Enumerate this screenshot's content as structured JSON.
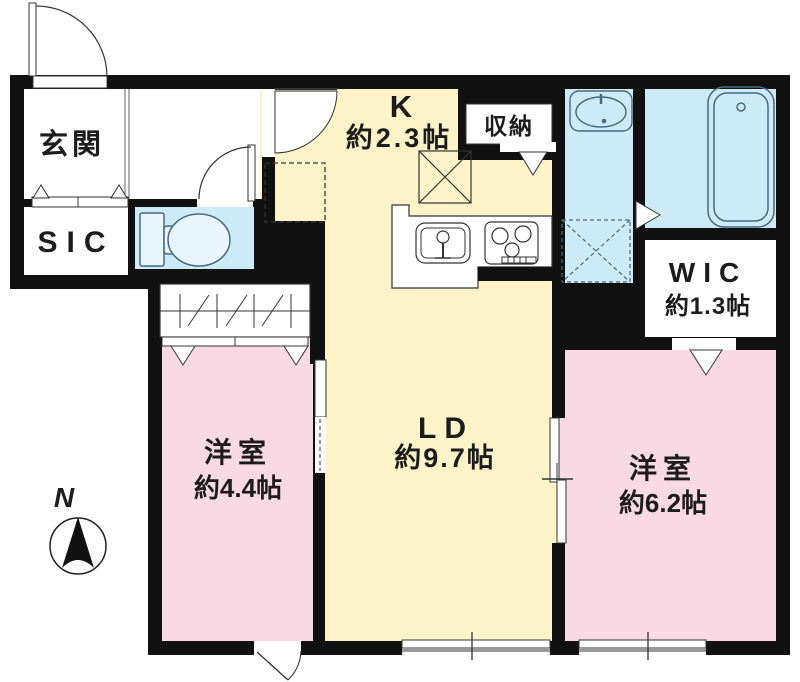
{
  "plan": {
    "rooms": {
      "genkan": {
        "label": "玄関"
      },
      "sic": {
        "label": "SIC"
      },
      "kitchen": {
        "label": "K",
        "size": "約2.3帖"
      },
      "storage": {
        "label": "収納"
      },
      "living_dining": {
        "label": "LD",
        "size": "約9.7帖"
      },
      "wic": {
        "label": "WIC",
        "size": "約1.3帖"
      },
      "bedroom_west": {
        "label": "洋室",
        "size": "約4.4帖"
      },
      "bedroom_east": {
        "label": "洋室",
        "size": "約6.2帖"
      }
    },
    "compass": {
      "north_label": "N"
    },
    "colors": {
      "wall": "#111111",
      "kitchen_living": "#fcf3c8",
      "bedroom": "#f9d9e3",
      "wet_area": "#cdeaf7",
      "line": "#333333",
      "fixture_line": "#476a80"
    },
    "fixtures": [
      "entrance-door",
      "toilet",
      "washbasin",
      "bathtub",
      "washing-machine-space",
      "refrigerator-space",
      "kitchen-counter",
      "sink",
      "gas-stove",
      "bifold-closet",
      "sliding-door",
      "window",
      "compass"
    ]
  }
}
